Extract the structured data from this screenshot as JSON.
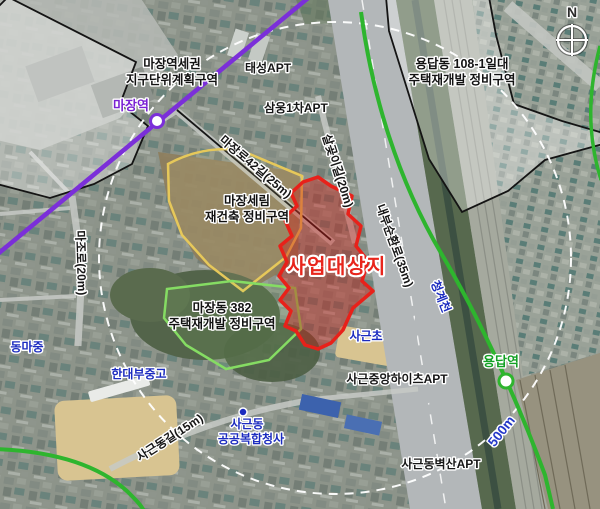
{
  "compass": {
    "label": "N"
  },
  "site": {
    "label": "사업대상지"
  },
  "zones": {
    "majang_station_area": {
      "line1": "마장역세권",
      "line2": "지구단위계획구역"
    },
    "yongdap_108": {
      "line1": "용답동 108-1일대",
      "line2": "주택재개발 정비구역"
    },
    "majang_serim": {
      "line1": "마장세림",
      "line2": "재건축 정비구역"
    },
    "majang_382": {
      "line1": "마장동 382",
      "line2": "주택재개발 정비구역"
    }
  },
  "transit": {
    "stations": {
      "majang": "마장역",
      "yongdap": "용답역"
    }
  },
  "roads": {
    "majangro_42": "마장로42길(25m)",
    "salgoji_gil": "살곶이길(20m)",
    "naebu_sunhwanro": "내부순환로(35m)",
    "majoro": "마조로(20m)",
    "sageundong_gil": "사근동길(15m)"
  },
  "places": {
    "taeseong_apt": "태성APT",
    "samung_1cha_apt": "삼웅1차APT",
    "dongma_middle": "동마중",
    "handae_middle_high": "한대부중고",
    "sageun_elementary": "사근초",
    "sageun_complex_line1": "사근동",
    "sageun_complex_line2": "공공복합청사",
    "sageun_heights_apt": "사근중앙하이츠APT",
    "sageun_byeoksan_apt": "사근동벽산APT"
  },
  "water": {
    "cheonggyecheon": "청계천"
  },
  "radius_ring": {
    "label": "500m"
  },
  "colors": {
    "site_outline": "#e8211a",
    "site_fill": "rgba(205,25,18,0.40)",
    "subway_purple": "#7b2fd9",
    "subway_green": "#2eb52e",
    "zone_yellow": "#e6c85a",
    "zone_green": "#85dc63",
    "label_blue": "#1b2bbf"
  }
}
